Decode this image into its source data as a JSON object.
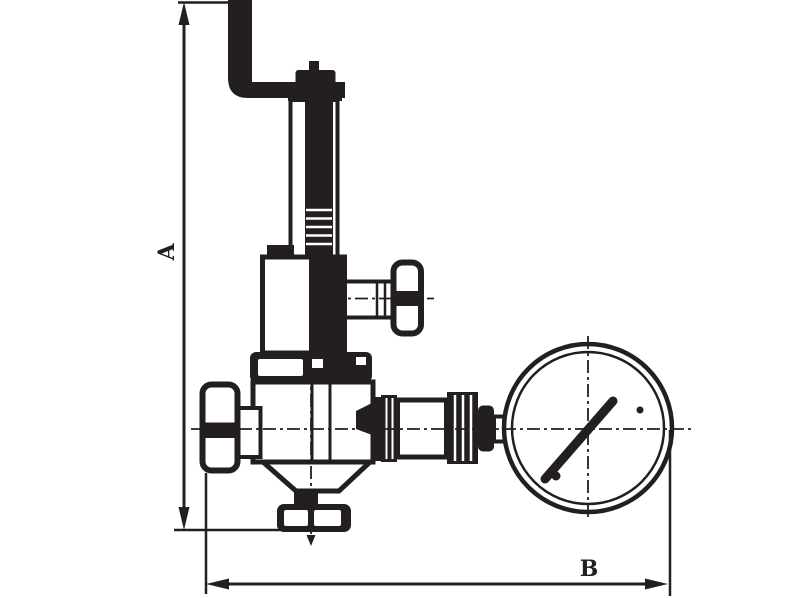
{
  "figure": {
    "title": "Dimensioned outline drawing of a pressure reducing valve with pressure gauge",
    "type": "technical-line-drawing",
    "background_color": "#ffffff",
    "line_color": "#231f20",
    "dimension_labels": {
      "vertical": "A",
      "horizontal": "B"
    },
    "components": [
      "exhaust-elbow-pipe",
      "valve-top-cap",
      "spring-bonnet-tube",
      "spring-chamber",
      "side-tee-handle",
      "valve-body",
      "inlet-tee-handle",
      "union-fittings",
      "pressure-gauge",
      "gauge-needle",
      "bottom-outlet-flange"
    ]
  }
}
